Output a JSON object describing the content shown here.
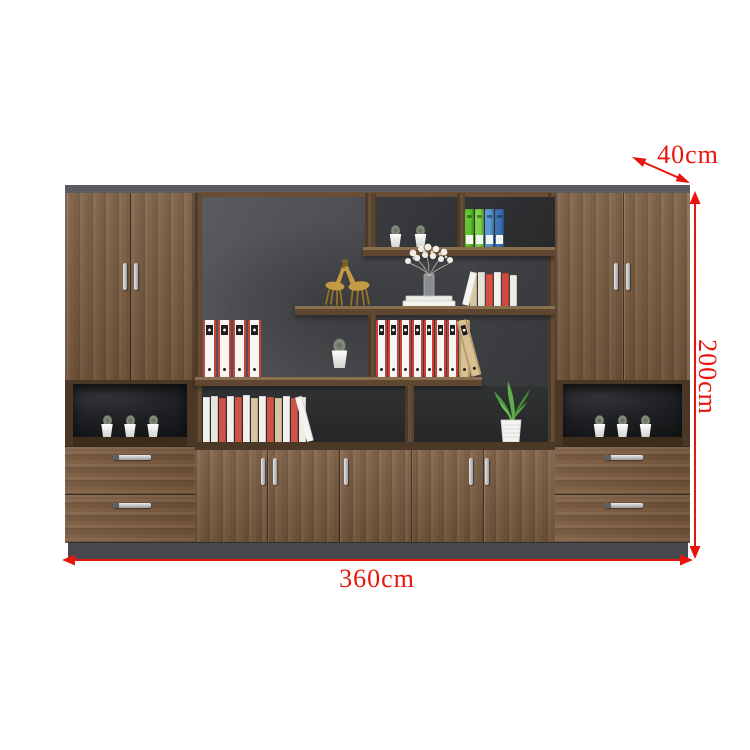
{
  "dimensions": {
    "width_label": "360cm",
    "height_label": "200cm",
    "depth_label": "40cm"
  },
  "colors": {
    "annotation": "#e8150e",
    "wood": "#7b5c40",
    "wood_dark": "#5c452e",
    "back_panel": "#4b4d50",
    "base": "#47494c"
  },
  "decor": {
    "items": [
      "gold-deer-figurines",
      "white-flower-vase-on-books",
      "green-potted-plant",
      "succulent-pots",
      "file-binders",
      "book-rows"
    ],
    "niche_pot_count": 3,
    "box_pot_count": 2,
    "box_binder_colors": [
      "#61c433",
      "#7fd24a",
      "#5b9bd5",
      "#3d72b4"
    ],
    "left_binder_types": [
      "w",
      "w",
      "w",
      "w"
    ],
    "right_binder_types": [
      "w",
      "w",
      "w",
      "w",
      "w",
      "w",
      "w",
      "t",
      "t-lean"
    ],
    "shelf2_books": [
      {
        "c": "#f6f4f0",
        "h": 34,
        "lean": "r"
      },
      {
        "c": "#d9c5a2",
        "h": 33
      },
      {
        "c": "#e8e2d8",
        "h": 34
      },
      {
        "c": "#d44f42",
        "h": 32
      },
      {
        "c": "#f4f1ec",
        "h": 34
      },
      {
        "c": "#cf4a3e",
        "h": 33
      },
      {
        "c": "#efece6",
        "h": 31
      }
    ],
    "bottom_books": [
      {
        "c": "#f2f0ec",
        "h": 45
      },
      {
        "c": "#e9e6e0",
        "h": 46
      },
      {
        "c": "#cf5448",
        "h": 44
      },
      {
        "c": "#f2f0ec",
        "h": 46
      },
      {
        "c": "#cf5448",
        "h": 45
      },
      {
        "c": "#f2f0ec",
        "h": 47
      },
      {
        "c": "#d8c5a0",
        "h": 44
      },
      {
        "c": "#f2f0ec",
        "h": 46
      },
      {
        "c": "#cf5448",
        "h": 45
      },
      {
        "c": "#d8c5a0",
        "h": 44
      },
      {
        "c": "#f2f0ec",
        "h": 46
      },
      {
        "c": "#cf5448",
        "h": 44
      },
      {
        "c": "#efece6",
        "h": 45
      },
      {
        "c": "#f6f4f0",
        "h": 46,
        "lean": "l"
      }
    ]
  }
}
